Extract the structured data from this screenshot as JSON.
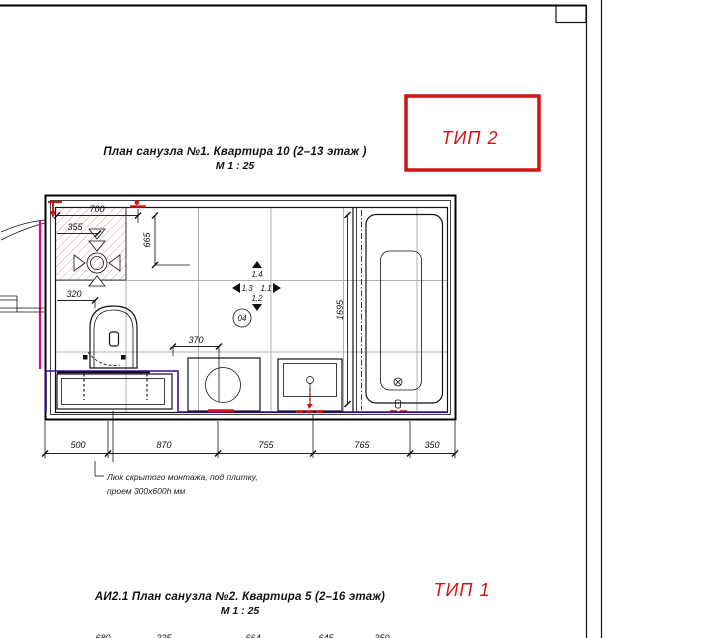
{
  "plan_top": {
    "title": "План санузла №1. Квартира 10 (2–13 этаж )",
    "scale": "М 1 : 25",
    "type_badge": "ТИП 2"
  },
  "plan_bottom": {
    "title": "АИ2.1 План санузла №2. Квартира 5 (2–16 этаж)",
    "scale": "М 1 : 25",
    "type_badge": "ТИП 1"
  },
  "note": {
    "line1": "Люк скрытого монтажа, под плитку,",
    "line2": "проем 300х600h мм"
  },
  "dims": {
    "d700": "700",
    "d355": "355",
    "d665": "665",
    "d320": "320",
    "d370": "370",
    "d1695": "1695",
    "bottom": [
      "500",
      "870",
      "755",
      "765",
      "350"
    ],
    "bottom_partial": [
      "680",
      "335",
      "664",
      "645",
      "350"
    ]
  },
  "markers": {
    "up": "1.4",
    "left": "1.3",
    "right": "1.1",
    "down": "1.2",
    "node": "04"
  },
  "colors": {
    "accent_red": "#d01414",
    "riser_magenta": "#ec008c",
    "pipe_purple": "#3a0ca3",
    "hatch_red": "#e89090",
    "tile_grid_gray": "#b0b0b0"
  }
}
